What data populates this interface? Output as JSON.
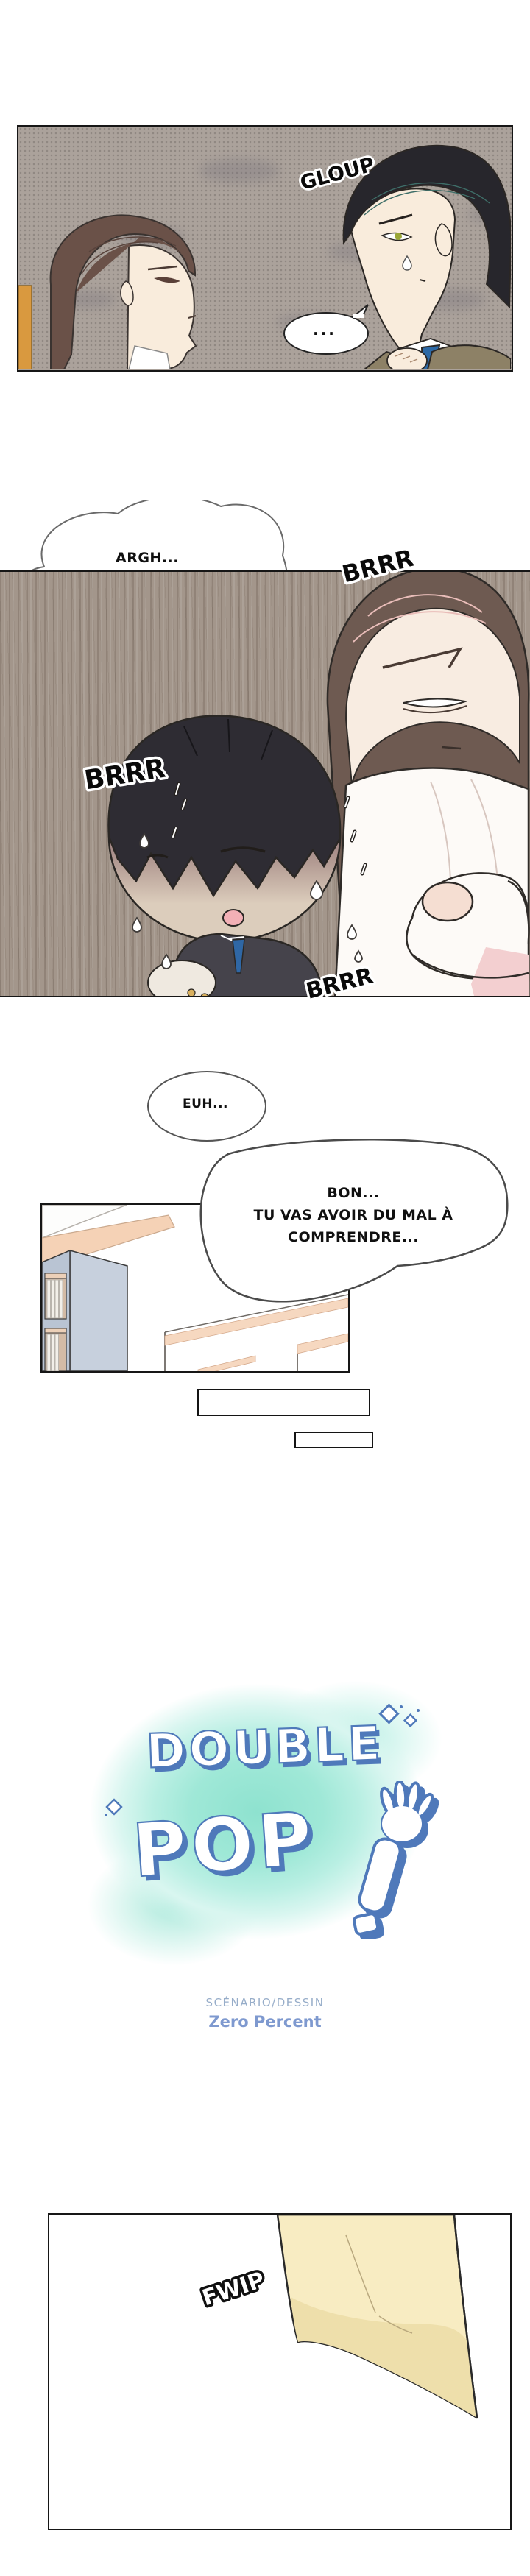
{
  "comic": {
    "panel1": {
      "sfx_gloup": "GLOUP",
      "speech_ellipsis": "..."
    },
    "thought_bubble": {
      "lines": [
        "ARGH...",
        "ILS ME POSENT TOUS",
        "LES DEUX LA MÊME QUESTION,",
        "PUISQU'ILS SONT",
        "IDENTIQUES..."
      ]
    },
    "panel2": {
      "sfx_brrr_top": "BRRR",
      "sfx_brrr_left": "BRRR",
      "sfx_brrr_bottom": "BRRR"
    },
    "panel3": {
      "speech_euh": "EUH...",
      "speech_bon_lines": [
        "BON...",
        "TU VAS AVOIR DU MAL À",
        "COMPRENDRE..."
      ]
    },
    "title": {
      "word1": "DOUBLE",
      "word2": "POP",
      "icons": [
        "waving-arm-icon",
        "sparkle-icon"
      ],
      "credit_role": "SCÉNARIO/DESSIN",
      "credit_name": "Zero Percent"
    },
    "panel5": {
      "sfx_fwip": "FWIP"
    },
    "colors": {
      "title_outline_blue": "#4f79ba",
      "watercolor_mint": "#8ee2cf",
      "credit_role_gray_blue": "#97adc9",
      "credit_name_blue": "#7e99cf",
      "panel1_taupe": "#aba29b",
      "panel2_wood": "#a3968b",
      "paper_cream": "#f8ecc2",
      "door_orange": "#d9993f",
      "tie_blue": "#2f67a5",
      "bookshelf_blue": "#c7d0dd",
      "trim_peach": "#f6d8c0"
    }
  }
}
